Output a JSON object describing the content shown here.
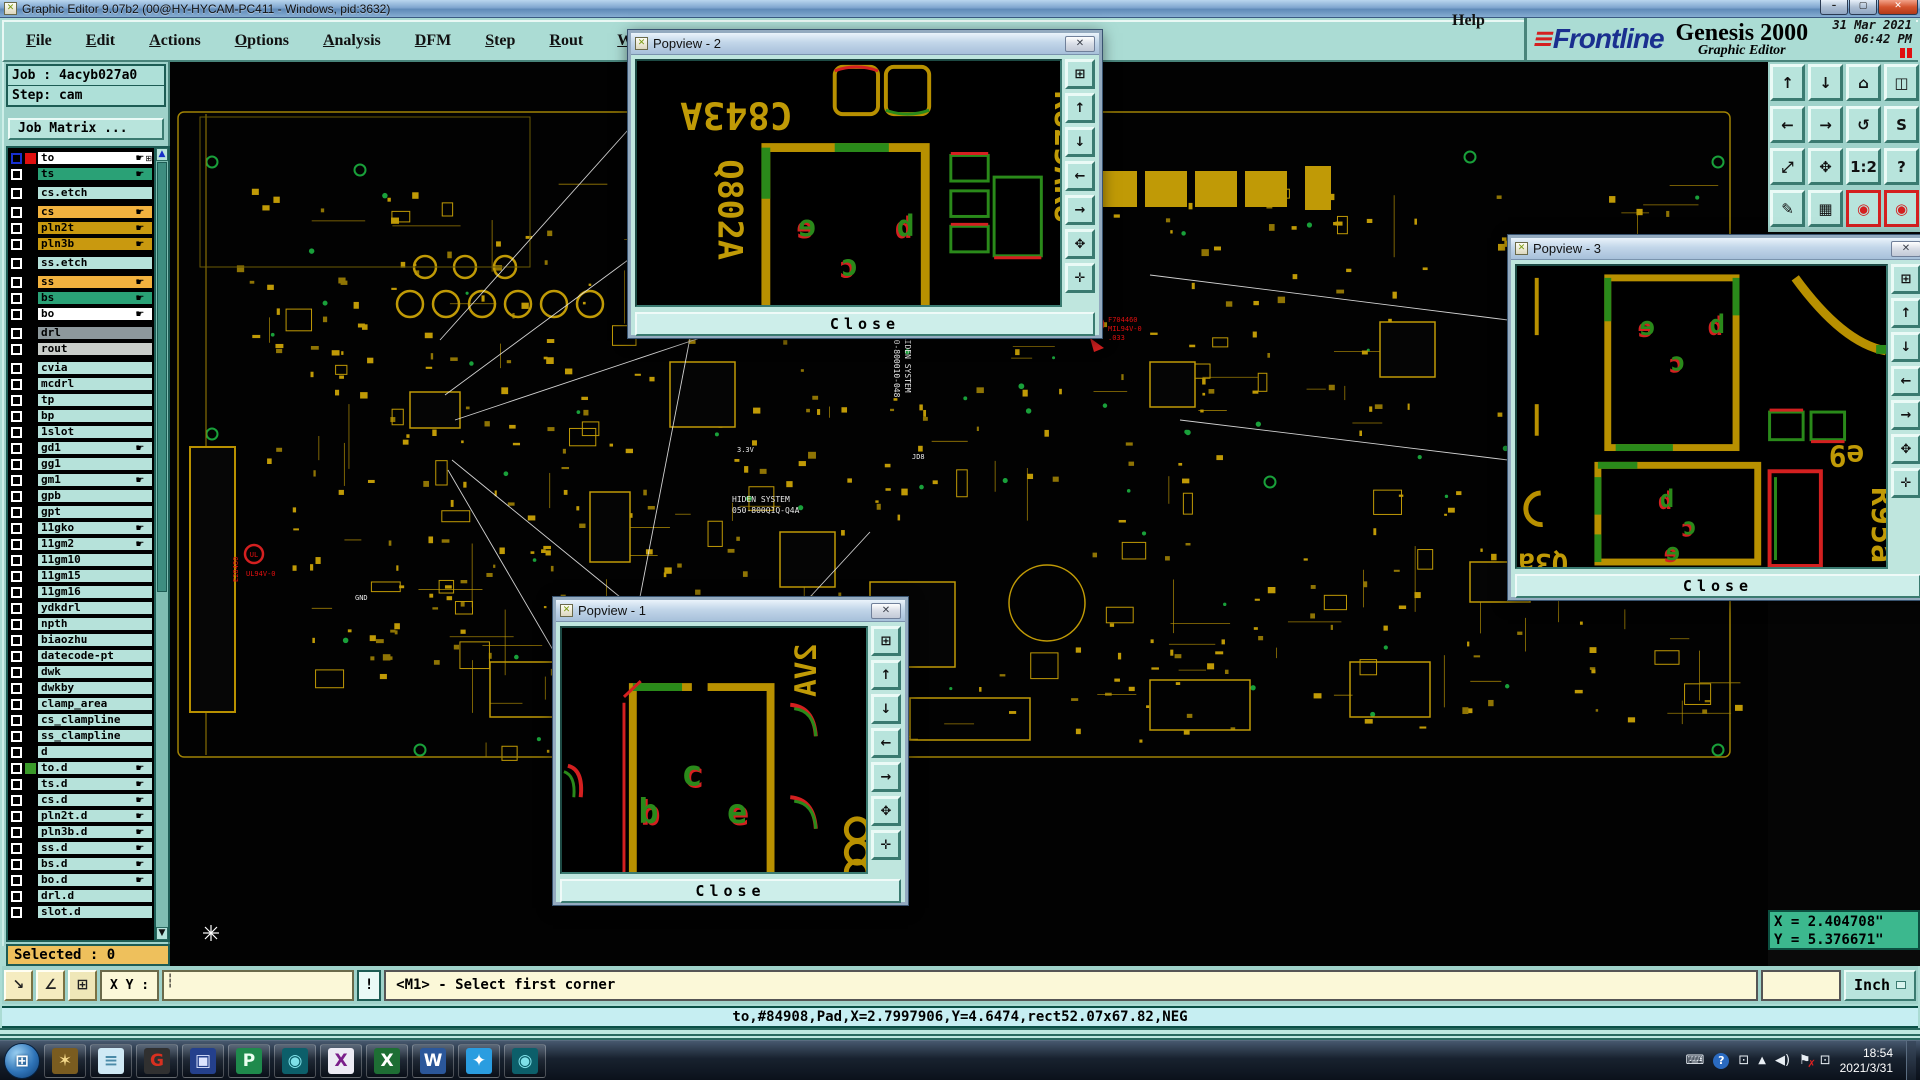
{
  "window": {
    "title": "Graphic Editor 9.07b2 (00@HY-HYCAM-PC411 - Windows, pid:3632)",
    "minimize": "–",
    "maximize": "▢",
    "close": "✕",
    "app_icon": "✕"
  },
  "menu": {
    "items": [
      {
        "label": "File"
      },
      {
        "label": "Edit"
      },
      {
        "label": "Actions"
      },
      {
        "label": "Options"
      },
      {
        "label": "Analysis"
      },
      {
        "label": "DFM"
      },
      {
        "label": "Step"
      },
      {
        "label": "Rout"
      },
      {
        "label": "Windows"
      }
    ],
    "help": "Help"
  },
  "brand": {
    "mark": "≡",
    "logo": "Frontline",
    "product": "Genesis 2000",
    "subtitle": "Graphic Editor",
    "date": "31 Mar 2021",
    "time": "06:42 PM"
  },
  "job": {
    "job_line": "Job : 4acyb027a0",
    "step_line": "Step: cam",
    "matrix_button": "Job Matrix ..."
  },
  "layers": [
    {
      "n": "to",
      "bg": "#ffffff",
      "chip": "#e01010",
      "hand": true,
      "extra": true,
      "cb": "#1830d0"
    },
    {
      "n": "ts",
      "bg": "#2aa176",
      "hand": true
    },
    {
      "n": "cs.etch",
      "bg": "#b6e2da",
      "gap": "7px"
    },
    {
      "n": "cs",
      "bg": "#f2b23e",
      "hand": true,
      "gap": "7px"
    },
    {
      "n": "pln2t",
      "bg": "#c9990f",
      "hand": true
    },
    {
      "n": "pln3b",
      "bg": "#c9990f",
      "hand": true
    },
    {
      "n": "ss.etch",
      "bg": "#b6e2da",
      "gap": "7px"
    },
    {
      "n": "ss",
      "bg": "#f2b23e",
      "hand": true,
      "gap": "7px"
    },
    {
      "n": "bs",
      "bg": "#2aa176",
      "hand": true
    },
    {
      "n": "bo",
      "bg": "#ffffff",
      "hand": true
    },
    {
      "n": "drl",
      "bg": "#8d989c",
      "gap": "7px"
    },
    {
      "n": "rout",
      "bg": "#c9cdc9"
    },
    {
      "n": "cvia",
      "bg": "#b6e2da",
      "gap": "7px"
    },
    {
      "n": "mcdrl",
      "bg": "#b6e2da"
    },
    {
      "n": "tp",
      "bg": "#b6e2da"
    },
    {
      "n": "bp",
      "bg": "#b6e2da"
    },
    {
      "n": "1slot",
      "bg": "#b6e2da"
    },
    {
      "n": "gd1",
      "bg": "#b6e2da",
      "hand": true
    },
    {
      "n": "gg1",
      "bg": "#b6e2da"
    },
    {
      "n": "gm1",
      "bg": "#b6e2da",
      "hand": true
    },
    {
      "n": "gpb",
      "bg": "#b6e2da"
    },
    {
      "n": "gpt",
      "bg": "#b6e2da"
    },
    {
      "n": "11gko",
      "bg": "#b6e2da",
      "hand": true
    },
    {
      "n": "11gm2",
      "bg": "#b6e2da",
      "hand": true
    },
    {
      "n": "11gm10",
      "bg": "#b6e2da"
    },
    {
      "n": "11gm15",
      "bg": "#b6e2da"
    },
    {
      "n": "11gm16",
      "bg": "#b6e2da"
    },
    {
      "n": "ydkdrl",
      "bg": "#b6e2da"
    },
    {
      "n": "npth",
      "bg": "#b6e2da"
    },
    {
      "n": "biaozhu",
      "bg": "#b6e2da"
    },
    {
      "n": "datecode-pt",
      "bg": "#b6e2da"
    },
    {
      "n": "dwk",
      "bg": "#b6e2da"
    },
    {
      "n": "dwkby",
      "bg": "#b6e2da"
    },
    {
      "n": "clamp_area",
      "bg": "#b6e2da"
    },
    {
      "n": "cs_clampline",
      "bg": "#b6e2da"
    },
    {
      "n": "ss_clampline",
      "bg": "#b6e2da"
    },
    {
      "n": "d",
      "bg": "#b6e2da"
    },
    {
      "n": "to.d",
      "bg": "#b6e2da",
      "chip": "#3a9a2a",
      "hand": true
    },
    {
      "n": "ts.d",
      "bg": "#b6e2da",
      "hand": true
    },
    {
      "n": "cs.d",
      "bg": "#b6e2da",
      "hand": true
    },
    {
      "n": "pln2t.d",
      "bg": "#b6e2da",
      "hand": true
    },
    {
      "n": "pln3b.d",
      "bg": "#b6e2da",
      "hand": true
    },
    {
      "n": "ss.d",
      "bg": "#b6e2da",
      "hand": true
    },
    {
      "n": "bs.d",
      "bg": "#b6e2da",
      "hand": true
    },
    {
      "n": "bo.d",
      "bg": "#b6e2da",
      "hand": true
    },
    {
      "n": "drl.d",
      "bg": "#b6e2da"
    },
    {
      "n": "slot.d",
      "bg": "#b6e2da"
    }
  ],
  "selected_bar": "Selected : 0",
  "statusbar": {
    "xy_label": "X Y :",
    "warn": "!",
    "prompt": "<M1> - Select first corner",
    "info": "to,#84908,Pad,X=2.7997906,Y=4.6474,rect52.07x67.82,NEG",
    "units": "Inch",
    "coord_x": "X = 2.404708\"",
    "coord_y": "Y = 5.376671\""
  },
  "toolbar": {
    "buttons": [
      {
        "g": "↑",
        "n": "pan-up-button"
      },
      {
        "g": "↓",
        "n": "pan-down-button"
      },
      {
        "g": "⌂",
        "n": "home-view-button"
      },
      {
        "g": "◫",
        "n": "split-window-xy-button"
      },
      {
        "g": "←",
        "n": "pan-left-button"
      },
      {
        "g": "→",
        "n": "pan-right-button"
      },
      {
        "g": "↺",
        "n": "previous-view-button"
      },
      {
        "g": "S",
        "n": "serpentine-button"
      },
      {
        "g": "⤢",
        "n": "zoom-extents-button"
      },
      {
        "g": "✥",
        "n": "center-view-button"
      },
      {
        "g": "1:2",
        "n": "scale-1-2-button"
      },
      {
        "g": "?",
        "n": "query-button"
      },
      {
        "g": "✎",
        "n": "setup-tools-button"
      },
      {
        "g": "▦",
        "n": "grid-button"
      },
      {
        "g": "◉",
        "n": "net-highlight-front-button",
        "c": "#d42020",
        "bc": "#d42020"
      },
      {
        "g": "◉",
        "n": "net-highlight-back-button",
        "c": "#d42020",
        "bc": "#d42020"
      }
    ]
  },
  "popview": {
    "close_label": "Close",
    "x_label": "✕",
    "toolbar": [
      {
        "g": "⊞",
        "n": "detach-view-button"
      },
      {
        "g": "↑",
        "n": "pan-up-button"
      },
      {
        "g": "↓",
        "n": "pan-down-button"
      },
      {
        "g": "←",
        "n": "pan-left-button"
      },
      {
        "g": "→",
        "n": "pan-right-button"
      },
      {
        "g": "✥",
        "n": "zoom-fit-button"
      },
      {
        "g": "✛",
        "n": "center-button"
      }
    ],
    "pv1": {
      "title": "Popview - 1",
      "letters": [
        "b",
        "c",
        "e"
      ],
      "corner_text": "2VA"
    },
    "pv2": {
      "title": "Popview - 2",
      "text_top": "C843A",
      "text_left": "Q802A",
      "text_right": "R825AR8",
      "letters": [
        "e",
        "c",
        "b"
      ]
    },
    "pv3": {
      "title": "Popview - 3",
      "text_e9": "e9",
      "text_r95a": "R95a",
      "text_q3a": "Q3a",
      "letters_top": [
        "e",
        "c",
        "b"
      ],
      "letters_bottom": [
        "b",
        "c",
        "e"
      ]
    }
  },
  "pcb": {
    "ul1_mark": "UL",
    "ul1_line1": "E28480",
    "ul1_line2": "UL94V-0",
    "ul2_mark": "UL",
    "ul2_line1": "F704460",
    "ul2_line2": "MIL94V-0",
    "ul2_line3": ".033",
    "white_v1": "TAIDEN SYSTEM",
    "white_v2": "D50-800010-048",
    "white_h1": "HIDEN SYSTEM",
    "white_h2": "050-800Q1Q-Q4A",
    "lbl_gnd": "GND",
    "lbl_33v": "3.3V",
    "lbl_jd8": "JD8"
  },
  "colors": {
    "gold": "#c09a06",
    "green": "#19a03a",
    "red": "#e01010",
    "chrome": "#abdcd4",
    "selected_orange": "#eec05c",
    "coord_green": "#3cb88e",
    "pad_red": "#ee1010",
    "pad_cyan": "#18e0e0"
  },
  "taskbar": {
    "apps": [
      {
        "g": "✶",
        "n": "taskbar-app-shell",
        "bg": "#7a5c20",
        "fg": "#f5d98a"
      },
      {
        "g": "≡",
        "n": "taskbar-app-notes",
        "bg": "#cfe9f5",
        "fg": "#4a8aa8"
      },
      {
        "g": "G",
        "n": "taskbar-app-g",
        "bg": "#303030",
        "fg": "#d83020"
      },
      {
        "g": "▣",
        "n": "taskbar-app-save",
        "bg": "#24408c",
        "fg": "#dce4ff"
      },
      {
        "g": "P",
        "n": "taskbar-app-p",
        "bg": "#1f8a4c",
        "fg": "#eafff0"
      },
      {
        "g": "◉",
        "n": "taskbar-app-cam",
        "bg": "#0c5f6a",
        "fg": "#7fe0e8"
      },
      {
        "g": "X",
        "n": "taskbar-app-xserver",
        "bg": "#ecebf4",
        "fg": "#7a1f8a"
      },
      {
        "g": "X",
        "n": "taskbar-app-excel",
        "bg": "#1e6e34",
        "fg": "#ffffff"
      },
      {
        "g": "W",
        "n": "taskbar-app-word",
        "bg": "#2b579a",
        "fg": "#ffffff"
      },
      {
        "g": "✦",
        "n": "taskbar-app-messenger",
        "bg": "#2a9de0",
        "fg": "#ffffff"
      },
      {
        "g": "◉",
        "n": "taskbar-app-cam2",
        "bg": "#0c5f6a",
        "fg": "#7fe0e8"
      }
    ],
    "tray": {
      "kb": "⌨",
      "help": "?",
      "win": "⊡",
      "up": "▲",
      "flag": "⚑",
      "flag_x": "✗"
    },
    "time": "18:54",
    "date": "2021/3/31"
  }
}
